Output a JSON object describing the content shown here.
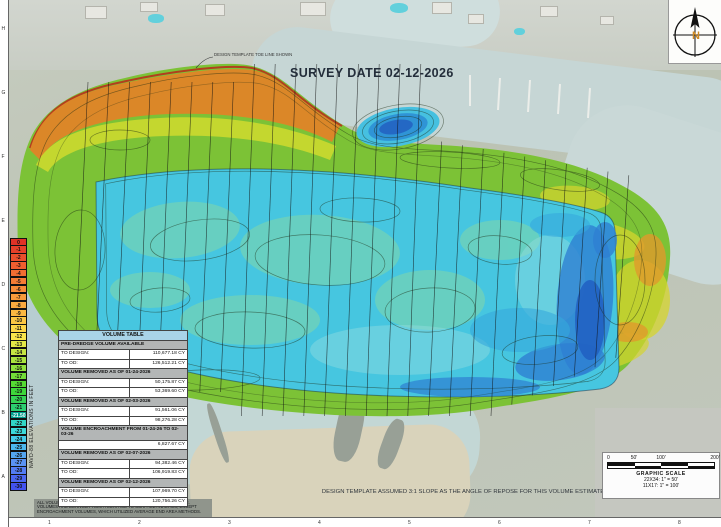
{
  "annotations": {
    "survey_date": "SURVEY DATE 02-12-2026",
    "design_template_note": "DESIGN TEMPLATE TOE LINE SHOWN",
    "slope_note": "DESIGN TEMPLATE ASSUMED 3:1 SLOPE AS THE ANGLE OF REPOSE FOR THIS VOLUME ESTIMATE",
    "disclaimer_lines": [
      "ALL VOLUMES ARE DERIVED FROM AN ASSUMED 3:1 ANGLE OF REPOSE.",
      "VOLUMES ARE DERIVED FROM A SURFACE TO SURFACE ANALYSIS, EXCEPT",
      "ENCROACHMENT VOLUMES, WHICH UTILIZED AVERAGE END AREA METHODS."
    ]
  },
  "legend": {
    "axis_label": "NAVD-88 ELEVATIONS IN FEET",
    "entries": [
      {
        "label": "0",
        "color": "#e03226"
      },
      {
        "label": "-1",
        "color": "#e64029"
      },
      {
        "label": "-2",
        "color": "#ea4f2c"
      },
      {
        "label": "-3",
        "color": "#ee5e2f"
      },
      {
        "label": "-4",
        "color": "#f16d32"
      },
      {
        "label": "-5",
        "color": "#f47c35"
      },
      {
        "label": "-6",
        "color": "#f68b38"
      },
      {
        "label": "-7",
        "color": "#f89a3b"
      },
      {
        "label": "-8",
        "color": "#faa93e"
      },
      {
        "label": "-9",
        "color": "#fcb841"
      },
      {
        "label": "-10",
        "color": "#fdc744"
      },
      {
        "label": "-11",
        "color": "#fed647"
      },
      {
        "label": "-12",
        "color": "#fbe54a"
      },
      {
        "label": "-13",
        "color": "#e3e947"
      },
      {
        "label": "-14",
        "color": "#c7e743"
      },
      {
        "label": "-15",
        "color": "#abe43f"
      },
      {
        "label": "-16",
        "color": "#8fe13b"
      },
      {
        "label": "-17",
        "color": "#72dd37"
      },
      {
        "label": "-18",
        "color": "#55da33"
      },
      {
        "label": "-19",
        "color": "#3ed63a"
      },
      {
        "label": "-20",
        "color": "#35d254"
      },
      {
        "label": "-21",
        "color": "#2cce70"
      },
      {
        "label": "-21.50",
        "color": "#009e8e",
        "text_color": "#ffffff"
      },
      {
        "label": "-22",
        "color": "#31d6c6"
      },
      {
        "label": "-23",
        "color": "#3bd9da"
      },
      {
        "label": "-24",
        "color": "#43cbe8"
      },
      {
        "label": "-25",
        "color": "#4bb8ee"
      },
      {
        "label": "-26",
        "color": "#53a5f1"
      },
      {
        "label": "-27",
        "color": "#5a92f3"
      },
      {
        "label": "-28",
        "color": "#537cf3"
      },
      {
        "label": "-29",
        "color": "#4a66f1"
      },
      {
        "label": "-30",
        "color": "#4252ef"
      }
    ]
  },
  "volume_table": {
    "title": "VOLUME TABLE",
    "sections": [
      {
        "header": "PRE-DREDGE VOLUME AVAILABLE",
        "rows": [
          {
            "label": "TO DESIGN:",
            "value": "110,677.18 CY"
          },
          {
            "label": "TO OD:",
            "value": "126,512.21 CY"
          }
        ]
      },
      {
        "header": "VOLUME REMOVED AS OF 01-24-2026",
        "rows": [
          {
            "label": "TO DESIGN:",
            "value": "50,175.87 CY"
          },
          {
            "label": "TO OD:",
            "value": "53,369.60 CY"
          }
        ]
      },
      {
        "header": "VOLUME REMOVED AS OF 02-03-2026",
        "rows": [
          {
            "label": "TO DESIGN:",
            "value": "91,561.06 CY"
          },
          {
            "label": "TO OD:",
            "value": "98,276.28 CY"
          }
        ]
      },
      {
        "header": "VOLUME ENCROACHMENT FROM 01-24-26 TO 02-03-26",
        "rows": [
          {
            "label": "",
            "value": "6,827.67 CY"
          }
        ]
      },
      {
        "header": "VOLUME REMOVED AS OF 02-07-2026",
        "rows": [
          {
            "label": "TO DESIGN:",
            "value": "94,382.46 CY"
          },
          {
            "label": "TO OD:",
            "value": "106,919.83 CY"
          }
        ]
      },
      {
        "header": "VOLUME REMOVED AS OF 02-12-2026",
        "rows": [
          {
            "label": "TO DESIGN:",
            "value": "107,969.70 CY"
          },
          {
            "label": "TO OD:",
            "value": "120,756.26 CY"
          }
        ]
      }
    ]
  },
  "compass": {
    "north_label": "N"
  },
  "graphic_scale": {
    "tick_labels": [
      "0",
      "50'",
      "100'",
      "200'"
    ],
    "title": "GRAPHIC SCALE",
    "scale_22x34": "22X34: 1\" = 50'",
    "scale_11x17": "11X17: 1\" = 100'"
  },
  "border_grid": {
    "left": [
      "H",
      "G",
      "F",
      "E",
      "D",
      "C",
      "B",
      "A"
    ],
    "bottom": [
      "1",
      "2",
      "3",
      "4",
      "5",
      "6",
      "7",
      "8"
    ]
  }
}
